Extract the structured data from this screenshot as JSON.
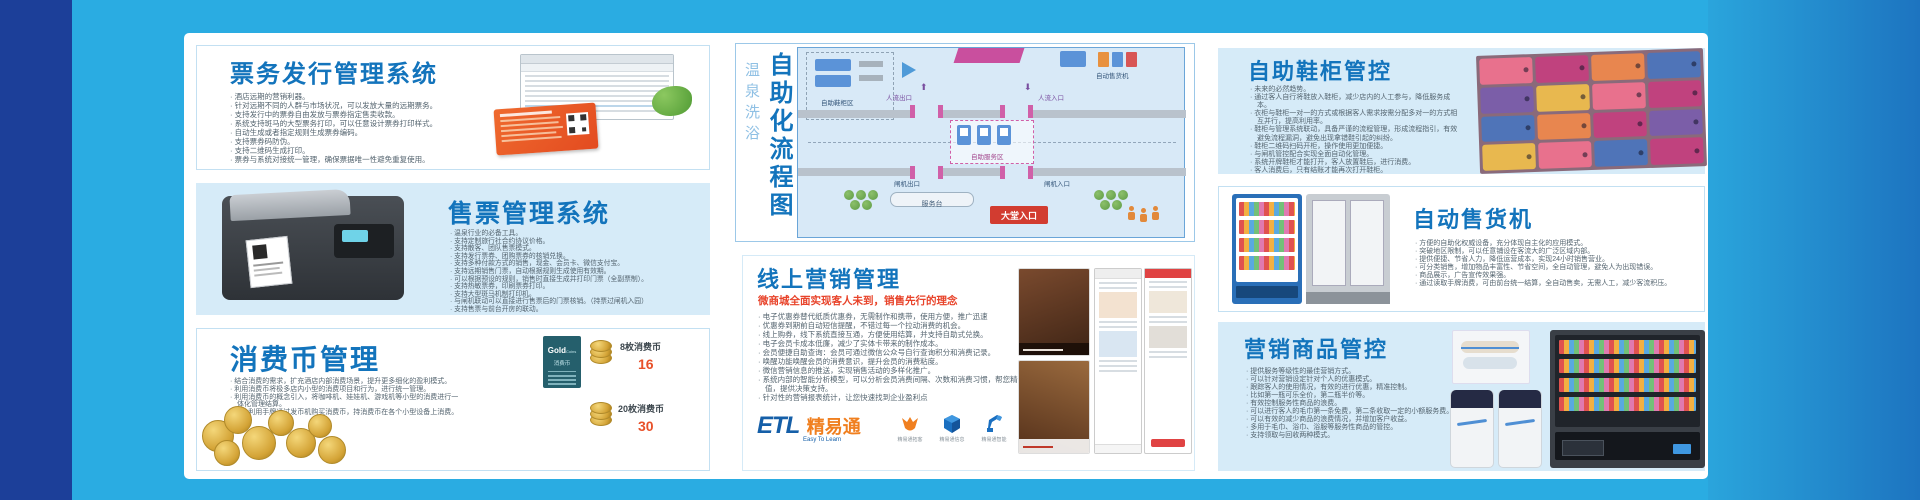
{
  "colors": {
    "page_bg": "#2aace2",
    "left_band": "#1c3f99",
    "panel_blue": "#d6ebf8",
    "title_blue": "#1374bc",
    "accent_red": "#e8432a",
    "body_text": "#54646f"
  },
  "left_panels": {
    "ticketing": {
      "title": "票务发行管理系统",
      "bullets": [
        "酒店远期的营销利器。",
        "针对远期不同的人群与市场状况，可以发放大量的远期票务。",
        "支持发行中的票券自由发放与票券指定售卖收款。",
        "系统支持斑马的大型票务打印，可以任意设计票券打印样式。",
        "自动生成或者指定规则生成票券编码。",
        "支持票券码防伪。",
        "支持二维码生成打印。",
        "票券与系统对接统一管理，确保票据唯一性避免重复使用。"
      ]
    },
    "sales": {
      "title": "售票管理系统",
      "bullets": [
        "温泉行业的必备工具。",
        "支持定制旅行社合约协议价格。",
        "支持散客、团队售票模式。",
        "支持发行票券、团购票券的核销兑换。",
        "支持多种付款方式的销售，现金、会员卡、微信支付宝。",
        "支持远期销售门票，自动根据规则生成使用有效期。",
        "可以根据预设的规则，销售时直接生成并打印门票（全副票制）。",
        "支持热敏票券，印刷票券打印。",
        "支持大型斑马机制打印机。",
        "与闸机联动可以直接进行售票后的门票核销。（持票过闸机入园）",
        "支持售票与前台开房的联动。"
      ]
    },
    "coins": {
      "title": "消费币管理",
      "bullets": [
        "结合消费的需求，扩充酒店内部消费场景，提升更多细化的盈利模式。",
        "利用消费币将极多店内小型的消费项目和行为，进行统一管理。",
        "利用消费币的概念引入，将咖啡机、娃娃机、游戏机等小型的消费进行一体化管理结算。",
        "客人利用手牌通过发币机购买消费币，持消费币在各个小型设备上消费。"
      ],
      "card": {
        "line1": "Gold",
        "line2": "Coins",
        "line3": "消费币"
      },
      "prices": [
        {
          "label": "8枚消费币",
          "value": "16"
        },
        {
          "label": "20枚消费币",
          "value": "30"
        }
      ]
    }
  },
  "center": {
    "flow": {
      "title": "自助化流程图",
      "subtitle": "温泉洗浴",
      "labels": {
        "locker_area": "自助鞋柜区",
        "vending": "自动售货机",
        "flow_out": "人流出口",
        "flow_in": "人流入口",
        "exit_gate": "闸机出口",
        "entry_gate": "闸机入口",
        "service_area": "自助服务区",
        "service_desk": "服务台",
        "hall_entrance": "大堂入口"
      }
    },
    "marketing": {
      "title": "线上营销管理",
      "subtitle": "微商城全面实现客人未到，销售先行的理念",
      "bullets": [
        "电子优惠券替代纸质优惠券，无需制作和携带，使用方便，推广迅速",
        "优惠券到期前自动短信提醒，不错过每一个拉动消费的机会。",
        "线上购券，线下系统直接互通，方便使用结算，并支持自助式兑换。",
        "电子会员卡成本低廉，减少了实体卡带来的制作成本。",
        "会员便捷自助查询：会员可通过微信公众号自行查询积分和消费记录。",
        "唤醒功能唤醒会员的消费意识，提升会员的消费粘度。",
        "微信营销信息的推送，实现销售活动的多样化推广。",
        "系统内部的智能分析模型，可以分析会员消费间隔、次数和消费习惯，帮您精准判断会员价值，提供决策支持。",
        "针对性的营销报表统计，让您快速找到企业盈利点"
      ],
      "logo": {
        "etl": "ETL",
        "brand": "精易通",
        "tagline": "Easy To Learn"
      },
      "logo_products": [
        {
          "caption": "精易通拓客"
        },
        {
          "caption": "精易通信息"
        },
        {
          "caption": "精易通智能"
        }
      ]
    }
  },
  "right_panels": {
    "shoe": {
      "title": "自助鞋柜管控",
      "bullets": [
        "未来的必然趋势。",
        "通过客人自行将鞋放入鞋柜，减少店内的人工参与，降低服务成本。",
        "衣柜与鞋柜一对一的方式或根据客人需求按需分配多对一的方式相互并行，提高利用率。",
        "鞋柜与管理系统联动，具备严谨的流程管理，形成流程指引，有效避免流程漏洞，避免出现拿错鞋引起的纠纷。",
        "鞋柜二维码扫码开柜，操作使用更加便捷。",
        "与闸机管控配合实现全面自动化管理。",
        "系统开牌鞋柜才能打开，客人放置鞋后，进行消费。",
        "客人消费后，只有结账才能再次打开鞋柜。"
      ]
    },
    "vending": {
      "title": "自动售货机",
      "bullets": [
        "方便的自助化权威设备，充分体现自主化的应用模式。",
        "突破地区限制，可以任意铺设在客流大的广泛区域内部。",
        "提供便捷、节省人力，降低运营成本，实现24小时销售营业。",
        "可分类销售，增加物品丰富性、节省空间，全自动管理，避免人为出现错误。",
        "商品展示，广告宣传效果强。",
        "通过读取手牌消费，可由前台统一结算，全自动售卖，无需人工，减少客流积压。"
      ]
    },
    "goods": {
      "title": "营销商品管控",
      "bullets": [
        "提供服务等级性的最佳营销方式。",
        "可以针对营销设定针对个人的优惠模式。",
        "跟踪客人的使用情况，有效的进行优惠，精准控制。",
        "比如第一瓶可乐全价，第二瓶半价等。",
        "有效控制服务性商品的浪费。",
        "可以进行客人的毛巾第一条免费，第二条收取一定的小额服务费。",
        "可以有效的减少商品的浪费情况，并增加客户收益。",
        "多用于毛巾、浴巾、浴服等服务性商品的管控。",
        "支持领取与回收两种模式。"
      ]
    }
  }
}
